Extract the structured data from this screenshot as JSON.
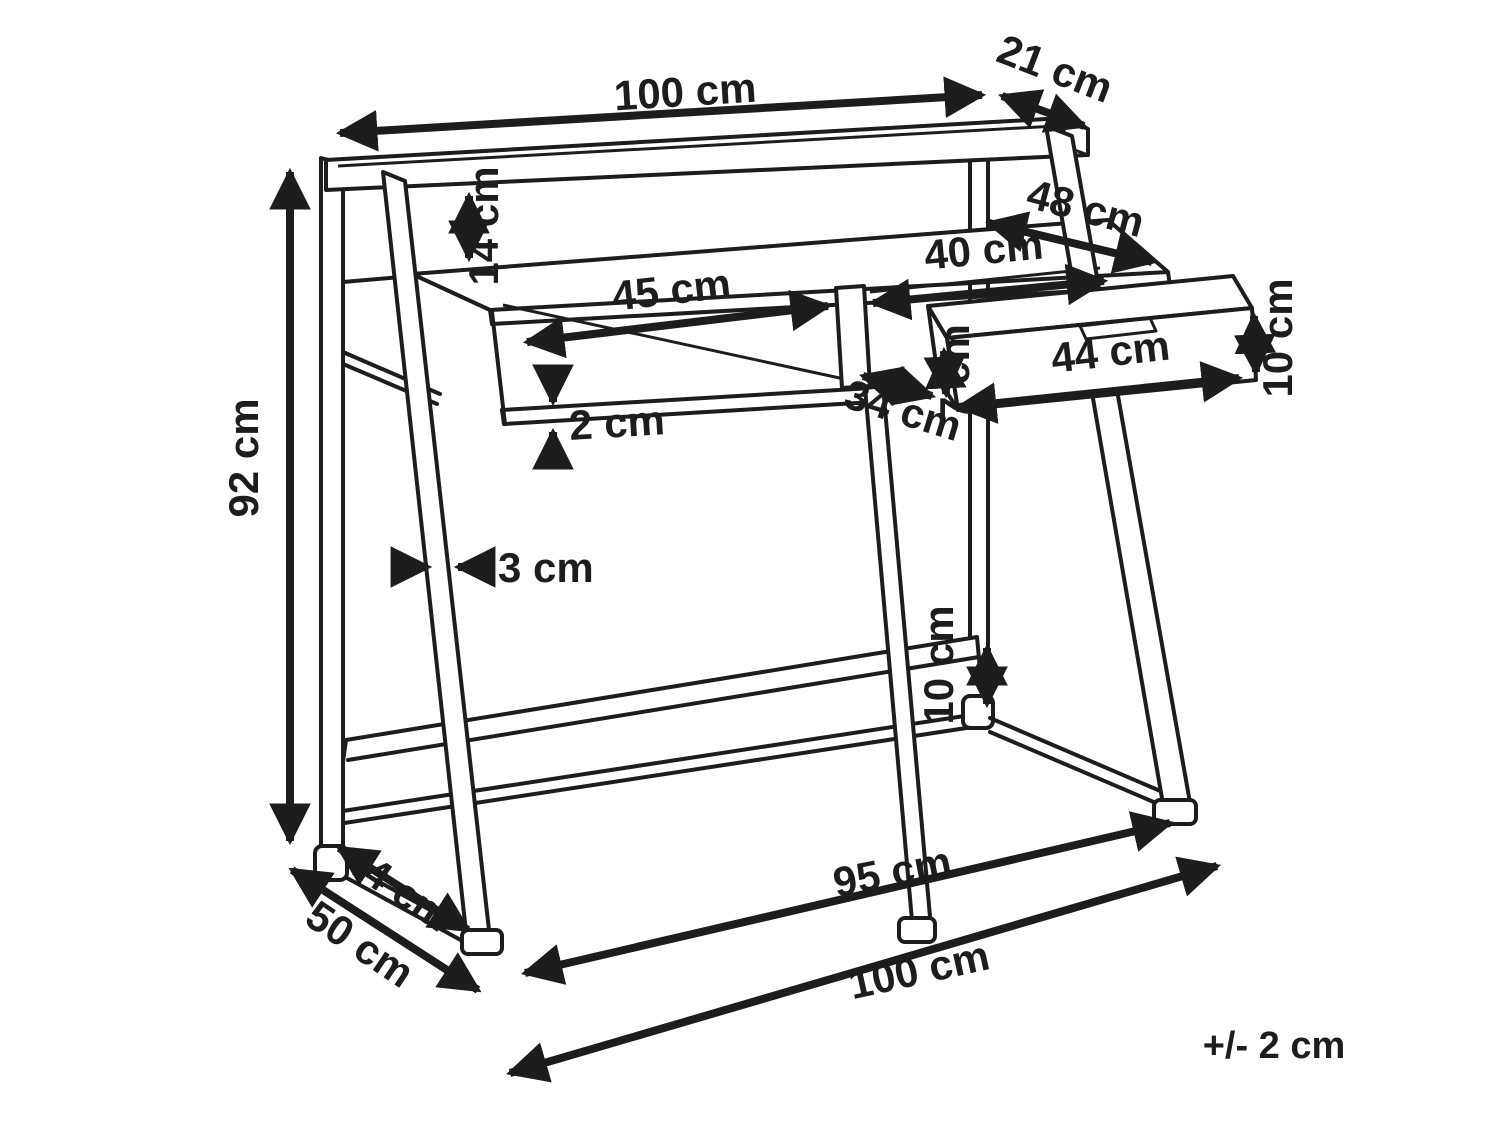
{
  "colors": {
    "line": "#1d1d1b",
    "background": "#ffffff"
  },
  "labels": {
    "top_width": "100 cm",
    "top_shelf_depth": "21 cm",
    "shelf_gap": "14 cm",
    "desktop_depth": "48 cm",
    "drawer_bay_width": "40 cm",
    "open_compartment_width": "45 cm",
    "drawer_side_height": "10 cm",
    "drawer_front_width": "44 cm",
    "drawer_front_height": "7 cm",
    "bay_depth": "34 cm",
    "board_thickness": "2 cm",
    "total_height": "92 cm",
    "frame_thickness": "3 cm",
    "rear_leg_offset": "10 cm",
    "base_depth_inner": "44 cm",
    "base_depth_outer": "50 cm",
    "base_width_inner": "95 cm",
    "base_width_outer": "100 cm",
    "tolerance": "+/- 2 cm"
  }
}
